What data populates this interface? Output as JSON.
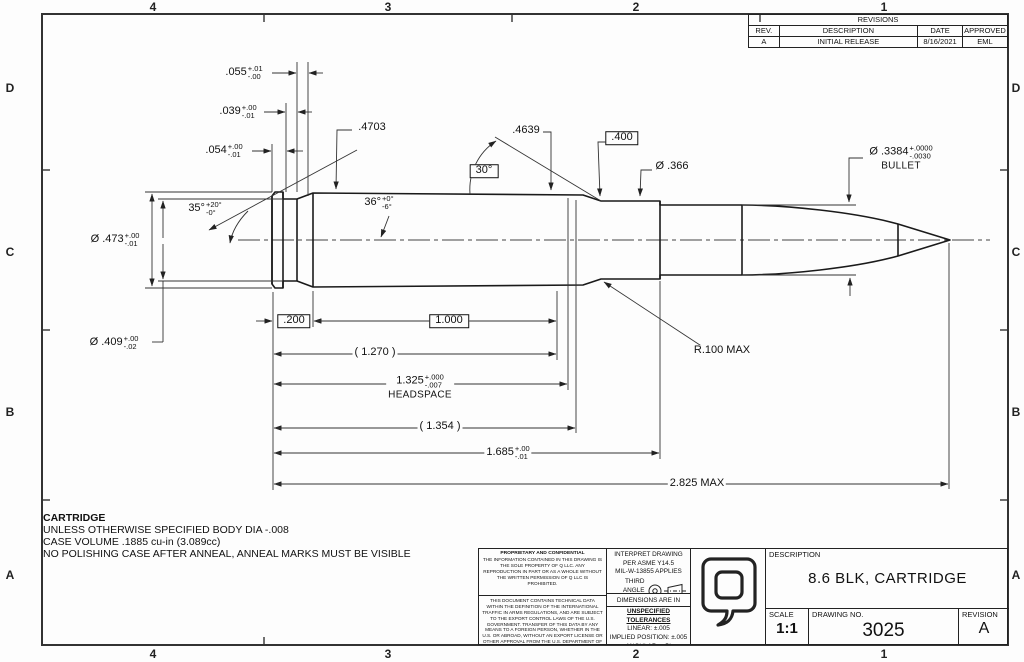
{
  "zones": {
    "top": [
      "4",
      "3",
      "2",
      "1"
    ],
    "bottom": [
      "4",
      "3",
      "2",
      "1"
    ],
    "left": [
      "D",
      "C",
      "B",
      "A"
    ],
    "right": [
      "D",
      "C",
      "B",
      "A"
    ]
  },
  "revisions_table": {
    "title": "REVISIONS",
    "headers": [
      "REV.",
      "DESCRIPTION",
      "DATE",
      "APPROVED"
    ],
    "row": [
      "A",
      "INITIAL RELEASE",
      "8/16/2021",
      "EML"
    ]
  },
  "dimensions": {
    "d055": {
      "value": ".055",
      "plus": "+.01",
      "minus": "-.00"
    },
    "d039": {
      "value": ".039",
      "plus": "+.00",
      "minus": "-.01"
    },
    "d054": {
      "value": ".054",
      "plus": "+.00",
      "minus": "-.01"
    },
    "d4703": {
      "value": ".4703"
    },
    "a35": {
      "value": "35°",
      "plus": "+20°",
      "minus": "-0°"
    },
    "a36": {
      "value": "36°",
      "plus": "+0°",
      "minus": "-6°"
    },
    "d4639": {
      "value": ".4639"
    },
    "a30": {
      "value": "30°"
    },
    "d400": {
      "value": ".400"
    },
    "d366": {
      "value": "Ø .366"
    },
    "d3384": {
      "value": "Ø .3384",
      "plus": "+.0000",
      "minus": "-.0030",
      "note": "BULLET"
    },
    "d473": {
      "value": "Ø .473",
      "plus": "+.00",
      "minus": "-.01"
    },
    "d409": {
      "value": "Ø .409",
      "plus": "+.00",
      "minus": "-.02"
    },
    "d200": {
      "value": ".200"
    },
    "d1000": {
      "value": "1.000"
    },
    "d1270": {
      "value": "( 1.270 )"
    },
    "d1325": {
      "value": "1.325",
      "plus": "+.000",
      "minus": "-.007",
      "note": "HEADSPACE"
    },
    "d1354": {
      "value": "( 1.354 )"
    },
    "d1685": {
      "value": "1.685",
      "plus": "+.00",
      "minus": "-.01"
    },
    "d2825": {
      "value": "2.825 MAX"
    },
    "r100": {
      "value": "R.100 MAX"
    }
  },
  "notes": {
    "title": "CARTRIDGE",
    "line1": "UNLESS OTHERWISE SPECIFIED BODY DIA -.008",
    "line2": "CASE VOLUME .1885 cu-in (3.089cc)",
    "line3": "NO POLISHING CASE AFTER ANNEAL, ANNEAL MARKS MUST BE VISIBLE"
  },
  "title_block": {
    "proprietary_title": "PROPRIETARY AND CONFIDENTIAL",
    "proprietary_body": "THE INFORMATION CONTAINED IN THIS DRAWING IS THE SOLE PROPERTY OF Q LLC.  ANY REPRODUCTION IN PART OR AS A WHOLE WITHOUT THE WRITTEN PERMISSION OF Q LLC IS PROHIBITED.",
    "itar_body": "THIS DOCUMENT CONTAINS TECHNICAL DATA WITHIN THE DEFINITION OF THE INTERNATIONAL TRAFFIC IN ARMS REGULATIONS, AND ARE SUBJECT TO THE EXPORT CONTROL LAWS OF THE U.S. GOVERNMENT. TRANSFER OF THIS DATA BY ANY MEANS TO A FOREIGN PERSON, WHETHER IN THE U.S. OR ABROAD, WITHOUT AN EXPORT LICENSE OR OTHER APPROVAL FROM THE U.S. DEPARTMENT OF STATE, IS PROHIBITED.",
    "interpret_line1": "INTERPRET DRAWING",
    "interpret_line2": "PER ASME Y14.5",
    "interpret_line3": "MIL-W-13855 APPLIES",
    "projection_label": "THIRD ANGLE PROJECTION",
    "units": "DIMENSIONS ARE IN INCHES",
    "tol_title": "UNSPECIFIED TOLERANCES",
    "tol_linear": "LINEAR: ±.005",
    "tol_position": "IMPLIED POSITION: ±.005",
    "tol_angular": "ANGULAR: ±.5°",
    "description_label": "DESCRIPTION",
    "description": "8.6 BLK, CARTRIDGE",
    "scale_label": "SCALE",
    "scale": "1:1",
    "drawing_no_label": "DRAWING NO.",
    "drawing_no": "3025",
    "revision_label": "REVISION",
    "revision": "A"
  }
}
